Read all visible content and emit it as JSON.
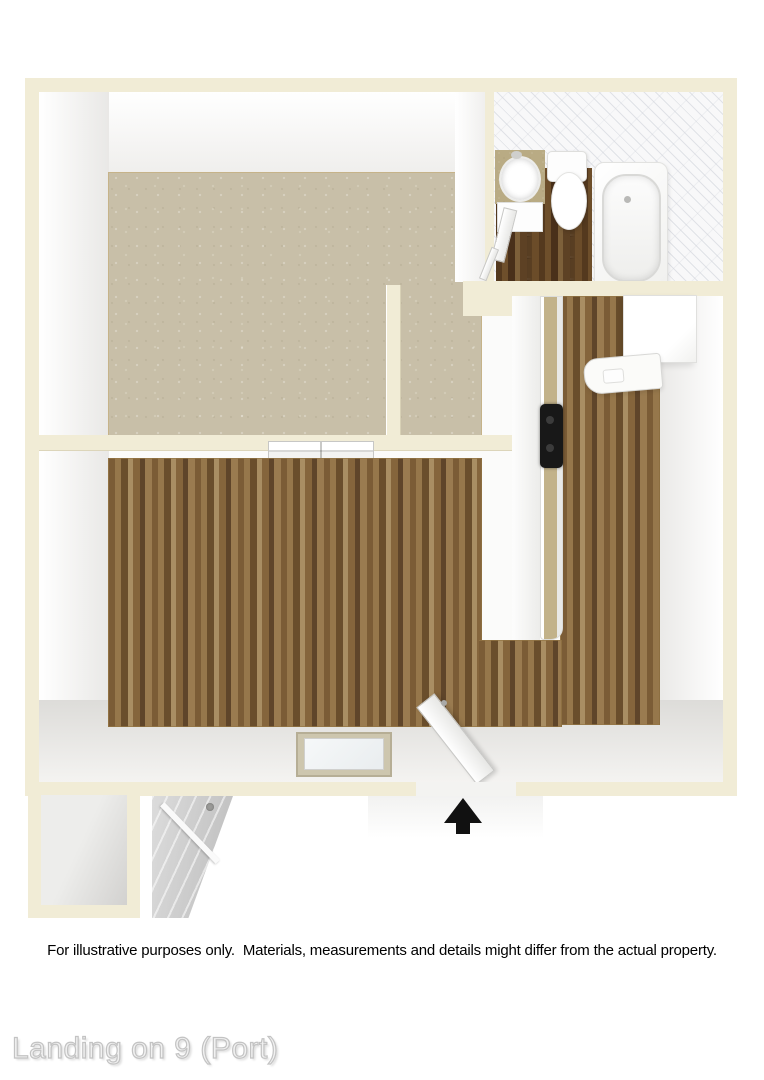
{
  "floorplan": {
    "title": "Landing on 9 (Port)",
    "disclaimer": "For illustrative purposes only.  Materials, measurements and details might differ from the actual property.",
    "rooms": [
      "bedroom",
      "bedroom-closet",
      "bathroom",
      "kitchen",
      "living-room",
      "entry",
      "exterior-storage-closet"
    ],
    "fixtures": [
      "bathroom-sink",
      "toilet",
      "bathtub",
      "kitchen-counter",
      "stove-cooktop",
      "kitchen-sink",
      "refrigerator",
      "closet-sliding-door",
      "entry-door",
      "exterior-door",
      "floor-window"
    ],
    "icons": {
      "entry_arrow": "up-arrow"
    },
    "colors": {
      "wall_cream": "#f1ecd6",
      "carpet": "#c8bfa8",
      "wood_light": "#8a6a42",
      "wood_dark": "#5e4427",
      "tile_white": "#f8f8f9",
      "counter_granite": "#b9ab84",
      "stove_black": "#181818",
      "door_gray": "#c6c6c6",
      "arrow_black": "#111111",
      "watermark_gray": "#c3c3c3"
    }
  }
}
